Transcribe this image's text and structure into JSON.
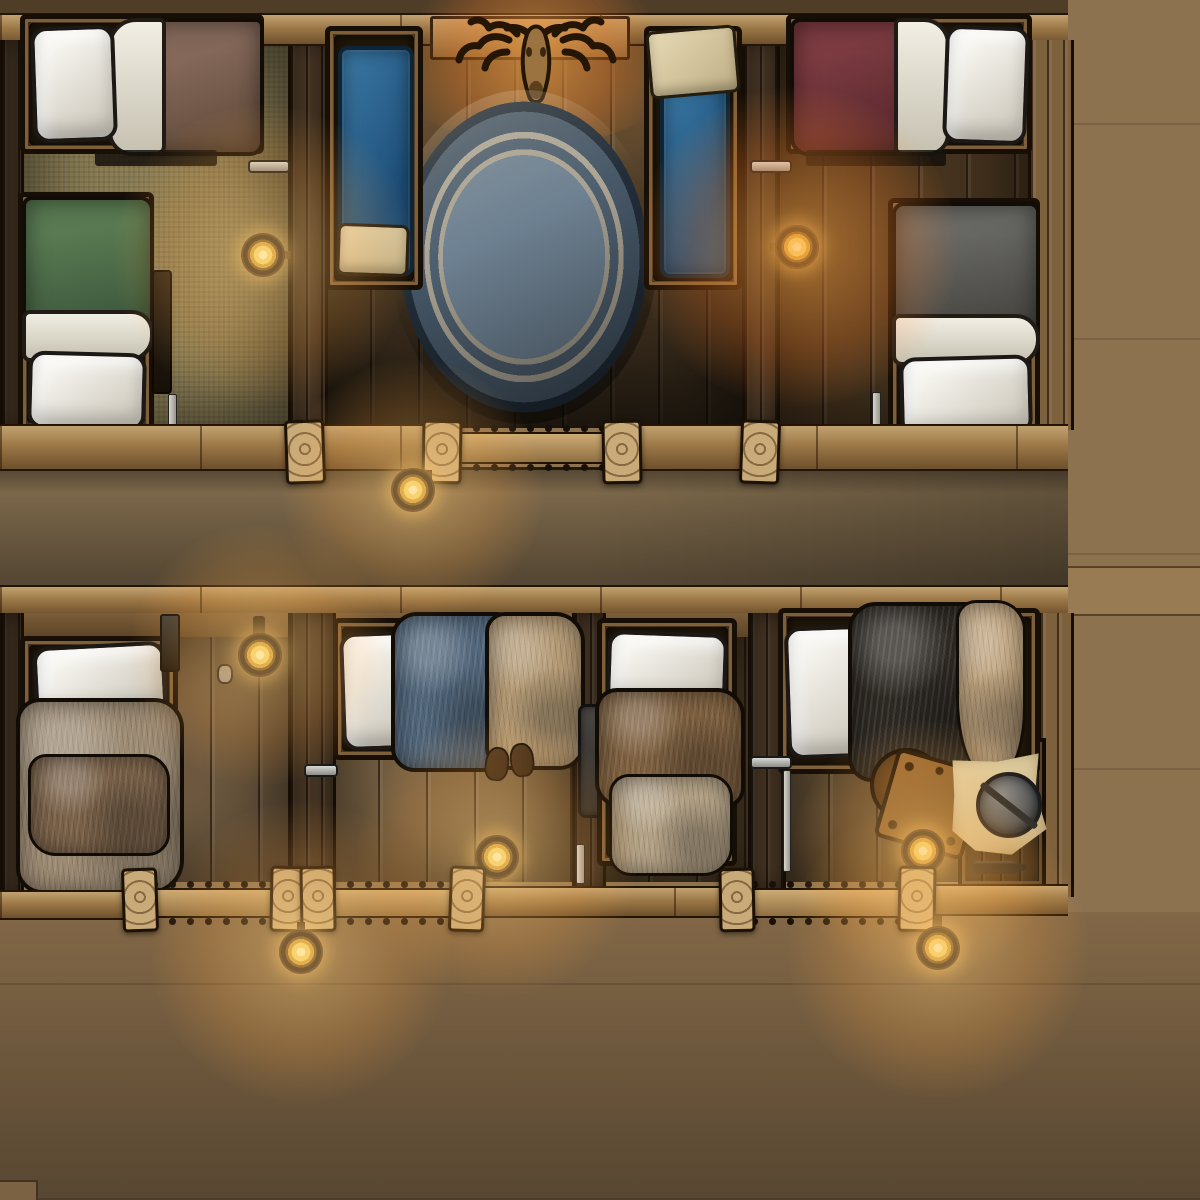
{
  "map": {
    "style": "hand-drawn top-down tabletop battle map",
    "setting": "wooden inn sleeping quarters: two cabin blocks joined by plank walkways and railed balconies",
    "palette": {
      "deck_wood": "#8d7250",
      "walkway_wood": "#7b674a",
      "beam_wood": "#9c7847",
      "dark_room_floor": "#57432b",
      "khaki_room_floor": "#8c7f57",
      "lantern_gold": "#f4d66b",
      "rug_field": "#6e8192",
      "rug_trim": "#aba494",
      "cot_blue": "#2f6d99"
    },
    "upper_block": {
      "rooms": [
        {
          "id": "cabin-nw",
          "floor": "woven khaki mat",
          "beds": [
            {
              "desc": "single bed, white pillow left, white sheet fold, brown blanket",
              "orientation": "horizontal"
            },
            {
              "desc": "single bed, green blanket top, white sheet fold, white pillow bottom",
              "orientation": "vertical"
            }
          ],
          "props": [
            "wall lantern",
            "door handle",
            "sword hung on wall",
            "standing candlestick"
          ]
        },
        {
          "id": "lounge-n",
          "floor": "dark walnut planks",
          "beds": [
            {
              "desc": "blue cot in wooden frame with cream cloth at foot",
              "orientation": "vertical",
              "side": "left"
            },
            {
              "desc": "blue cot in wooden frame with cream cloth at head",
              "orientation": "vertical",
              "side": "right"
            }
          ],
          "props": [
            "large round blue rug with cream rings",
            "stag-head trophy with candle glow",
            "wooden mantel shelf"
          ]
        },
        {
          "id": "cabin-ne",
          "floor": "dark planks lit amber",
          "beds": [
            {
              "desc": "single bed, maroon blanket left, white sheet fold, white pillow right",
              "orientation": "horizontal"
            },
            {
              "desc": "single bed, dark gray blanket top, white sheet fold, white pillow bottom",
              "orientation": "vertical"
            }
          ],
          "props": [
            "wall lantern",
            "door handle",
            "standing candlestick"
          ]
        }
      ]
    },
    "lower_block": {
      "rooms": [
        {
          "id": "cabin-sw",
          "beds": [
            {
              "desc": "single bed, white pillow top, large tan fur blanket with darker fur throw",
              "orientation": "vertical"
            }
          ],
          "props": [
            "wall lantern",
            "door handle",
            "wall hooks",
            "hanging dagger"
          ]
        },
        {
          "id": "cabin-s1",
          "beds": [
            {
              "desc": "single bed, white pillow left, blue fur blanket, tan fur at foot",
              "orientation": "horizontal"
            }
          ],
          "props": [
            "pair of boots at bedside",
            "wall lantern"
          ]
        },
        {
          "id": "cabin-s2",
          "beds": [
            {
              "desc": "single bed, white pillow top, brown fur blanket, pale fur at foot",
              "orientation": "vertical"
            }
          ],
          "props": [
            "satchel hung on wall",
            "standing candlestick"
          ]
        },
        {
          "id": "cabin-se",
          "beds": [
            {
              "desc": "single bed, white pillow left, black fur blanket, tan pelt drape",
              "orientation": "horizontal"
            }
          ],
          "props": [
            "round stool",
            "tilted square side table with nails",
            "parchment map",
            "round steel shield",
            "wooden trapdoor with iron hinges",
            "wall lantern",
            "door handle",
            "walking staff"
          ]
        }
      ]
    },
    "lanterns_total": 8,
    "railings": "spindled rail sections between carved end-grain posts on both cabin blocks",
    "decks": [
      "central walkway between blocks",
      "wide lower deck",
      "right-side deck"
    ]
  }
}
